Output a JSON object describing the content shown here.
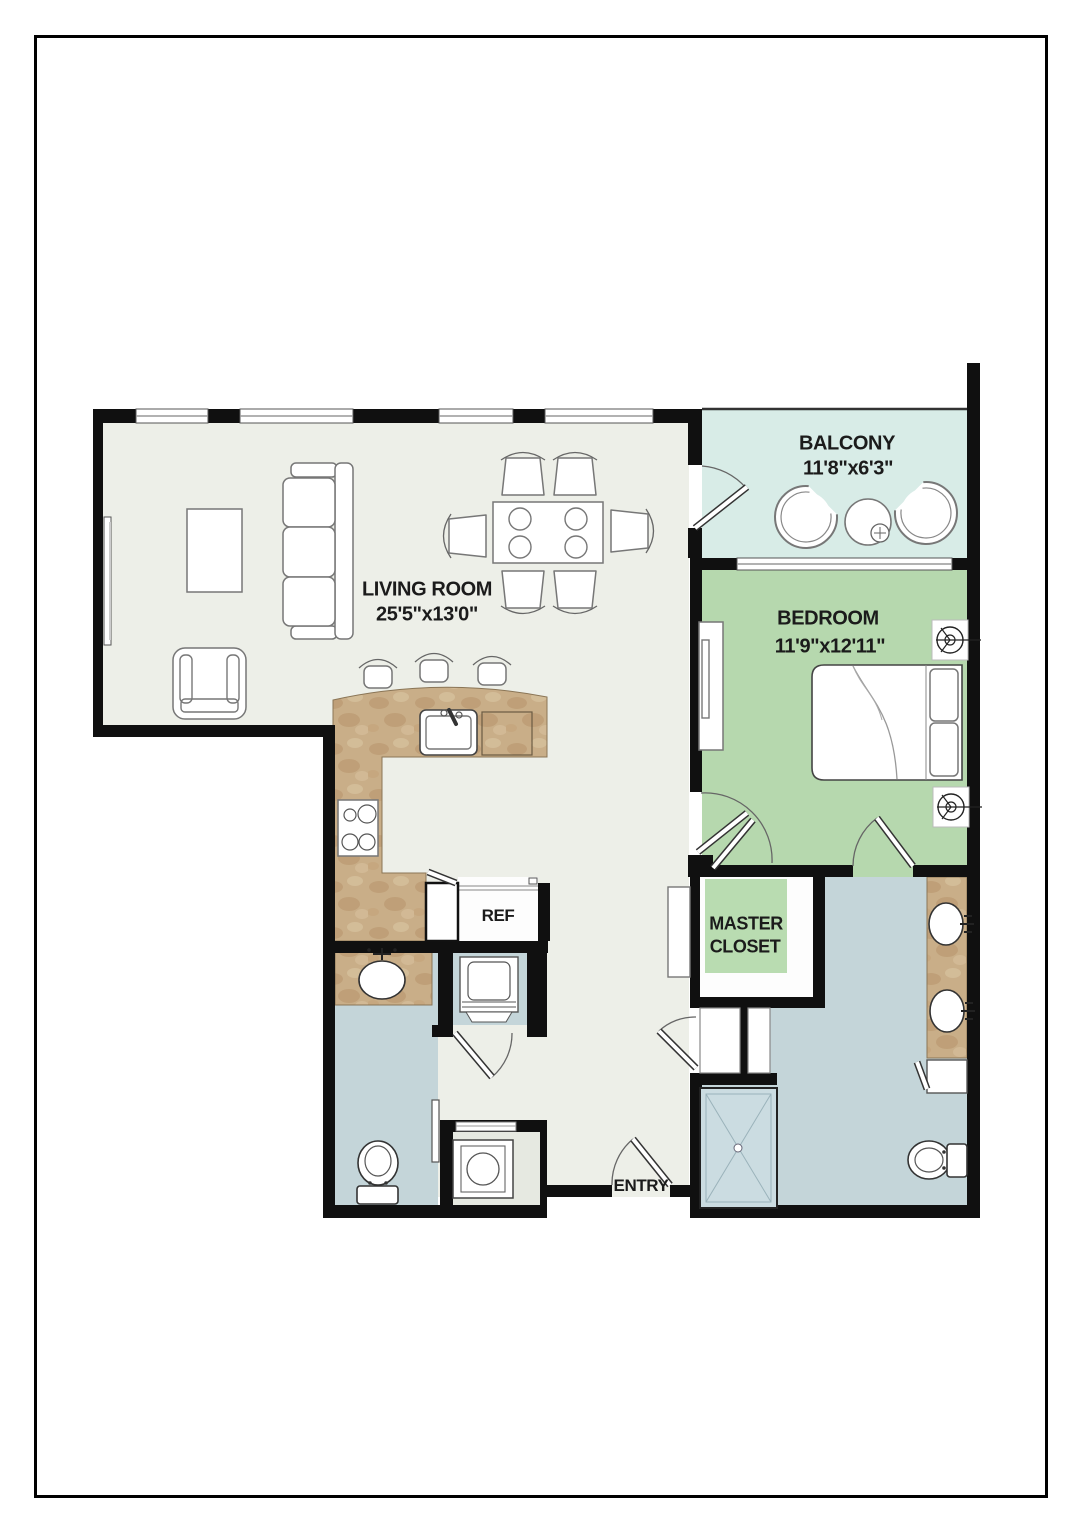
{
  "rooms": {
    "living_room": {
      "label": "LIVING ROOM",
      "dimensions": "25'5\"x13'0\""
    },
    "balcony": {
      "label": "BALCONY",
      "dimensions": "11'8\"x6'3\""
    },
    "bedroom": {
      "label": "BEDROOM",
      "dimensions": "11'9\"x12'11\""
    },
    "master_closet": {
      "label_line1": "MASTER",
      "label_line2": "CLOSET"
    },
    "kitchen": {
      "ref_label": "REF"
    },
    "entry": {
      "label": "ENTRY"
    }
  },
  "colors": {
    "wall": "#101010",
    "floor_main": "#edefe8",
    "balcony": "#d8ece7",
    "bedroom": "#b6d8ae",
    "closet_rug": "#b9dcb1",
    "bath": "#c4d5d9",
    "shower": "#cbdce1",
    "laundry2_floor": "#e6e9e1",
    "counter": "#c9ae88",
    "text": "#1b1b1b"
  }
}
